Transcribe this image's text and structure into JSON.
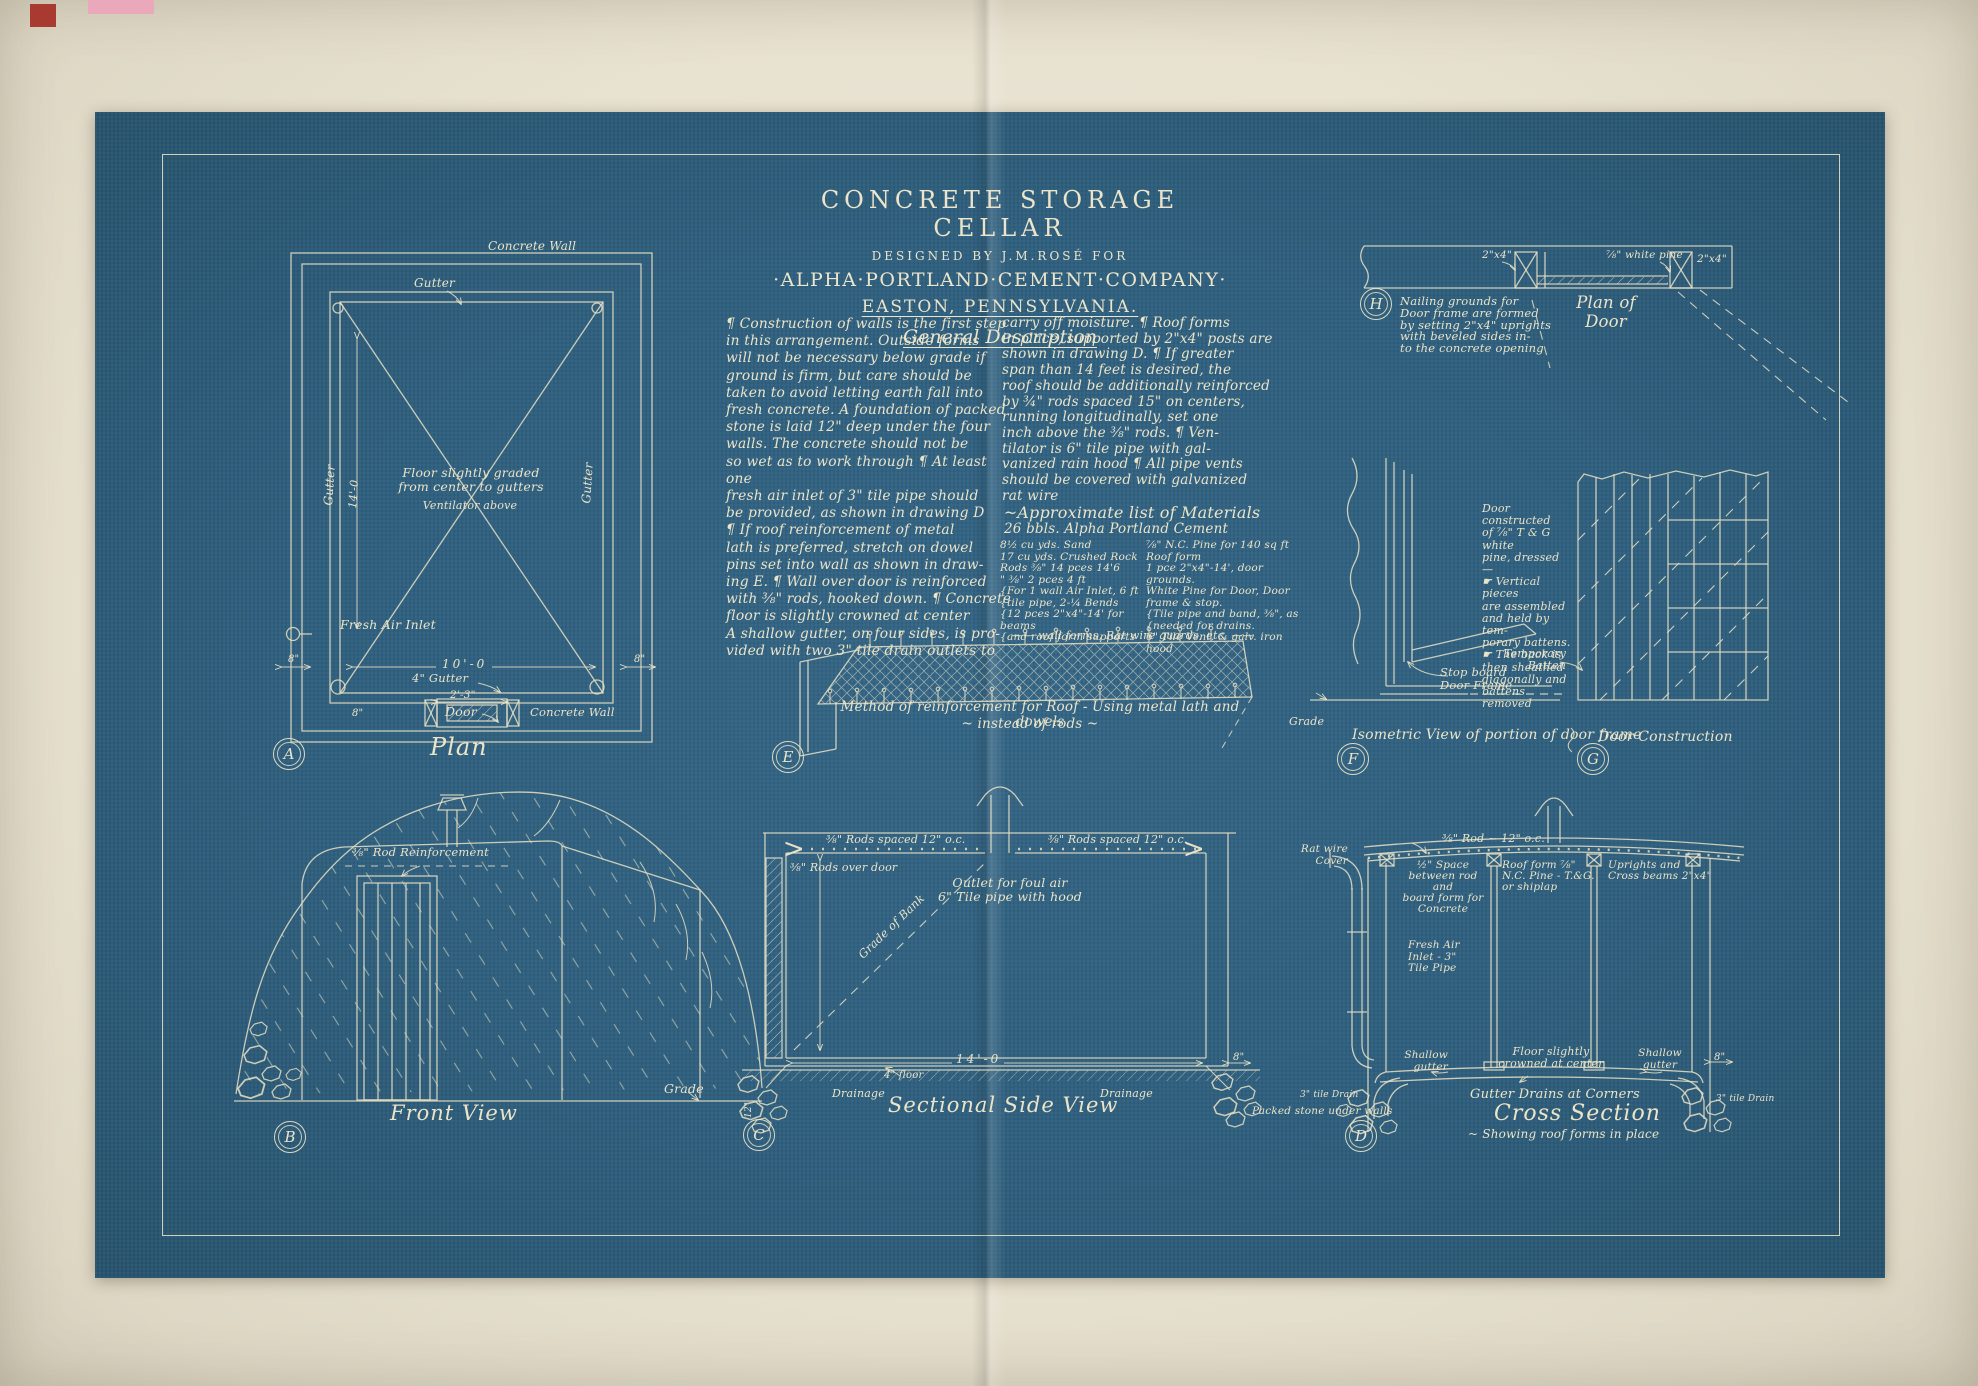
{
  "colors": {
    "blueprint": "#2e5f7e",
    "ink": "#ebe4c9",
    "paper": "#e8e2d1",
    "pink": "#e9a9bb",
    "red": "#a83a31"
  },
  "header": {
    "title": "CONCRETE STORAGE CELLAR",
    "designed_by": "DESIGNED BY J.M.ROSÉ FOR",
    "company": "·ALPHA·PORTLAND·CEMENT·COMPANY·",
    "location": "EASTON, PENNSYLVANIA.",
    "section": "General Description"
  },
  "description": {
    "col1": "¶  Construction of walls is the first step\nin this arrangement.  Outside forms\nwill not be necessary below grade if\nground is firm, but care should be\ntaken to avoid letting earth fall into\nfresh concrete. A foundation of packed\nstone is laid 12\" deep under the four\nwalls.  The concrete should not be\nso wet as to work through ¶ At least one\nfresh air inlet of 3\" tile pipe should\nbe provided, as shown in drawing D\n¶  If roof reinforcement of metal\nlath is preferred, stretch on dowel\npins set into wall as shown in draw-\ning E.  ¶ Wall over door is reinforced\nwith ⅜\" rods, hooked down. ¶ Concrete\nfloor is slightly crowned at center\nA shallow gutter, on four sides, is pro-\nvided with two 3\" tile drain outlets to",
    "col2": "carry off moisture.  ¶ Roof forms\nin place, supported by 2\"x4\" posts are\nshown in drawing D.  ¶ If greater\nspan than 14 feet is desired, the\nroof should be additionally reinforced\nby ¾\" rods spaced 15\" on centers,\nrunning longitudinally, set one\ninch above the ⅜\" rods.  ¶ Ven-\ntilator is 6\" tile pipe with gal-\nvanized rain hood ¶ All pipe vents\nshould be covered with galvanized\nrat wire"
  },
  "materials": {
    "heading": "~Approximate list of Materials",
    "cement": "26 bbls. Alpha Portland Cement",
    "left": "8½ cu yds. Sand\n17 cu yds. Crushed Rock\nRods ⅜\" 14 pces 14'6\n  \"   ⅜\"  2 pces  4 ft\n{For 1 wall Air Inlet, 6 ft\n{tile pipe, 2-¼ Bends\n{12 pces 2\"x4\"-14' for beams\n{and roof form supports",
    "right": "⅞\" N.C. Pine for 140 sq ft\nRoof form\n1 pce 2\"x4\"-14', door grounds.\nWhite Pine for Door, Door\nframe & stop.\n{Tile pipe and band, ⅜\", as\n{needed for drains.\n6\" Tile Vent. & galv. iron hood",
    "footer": "—— wall forms, Rat wire guards, etc. ——"
  },
  "plan": {
    "letter": "A",
    "caption": "Plan",
    "wall_top": "Concrete Wall",
    "gutter_top": "Gutter",
    "gutter_left": "Gutter",
    "gutter_right": "Gutter",
    "dim_height": "14'-0",
    "center_note": "Floor slightly graded\nfrom center to gutters",
    "center_sub": "Ventilator above",
    "fresh_air": "Fresh Air Inlet",
    "dim_width": "10'-0",
    "gutter_dim": "4\" Gutter",
    "wall_dim_left": "8\"",
    "wall_dim_right": "8\"",
    "door_dim": "2'-3\"",
    "door": "Door",
    "wall_bottom": "Concrete Wall",
    "door_wall_dim": "8\""
  },
  "lath": {
    "letter": "E",
    "caption1": "Method of reinforcement for Roof - Using metal lath and dowels",
    "caption2": "~ instead of rods ~"
  },
  "door_plan": {
    "letter": "H",
    "note": "Nailing grounds for\nDoor frame are formed\nby setting 2\"x4\" uprights\nwith beveled sides in-\nto the concrete opening",
    "label_left": "2\"x4\"",
    "label_pine": "⅞\" white pine",
    "label_right": "2\"x4\"",
    "caption": "Plan of\nDoor"
  },
  "frame_iso": {
    "letter": "F",
    "stop_board": "Stop board\nDoor Frame",
    "grade": "Grade",
    "caption": "Isometric View of portion of door frame"
  },
  "door_cons": {
    "letter": "G",
    "note": "Door constructed\nof ⅞\" T & G white\npine, dressed —\n☛ Vertical pieces\nare assembled\nand held by tem-\nporary battens.\n☛ The back is\nthen sheathed\ndiagonally and\nbattens removed",
    "batten": "Temporary\nBatten",
    "caption": "Door Construction"
  },
  "front": {
    "letter": "B",
    "rod": "⅜\" Rod Reinforcement",
    "grade": "Grade",
    "caption": "Front View"
  },
  "side_section": {
    "letter": "C",
    "rods_left": "⅜\" Rods spaced 12\" o.c.",
    "rods_right": "⅜\" Rods spaced 12\" o.c.",
    "rods_door": "⅜\" Rods over door",
    "outlet": "Outlet for foul air\n6\" Tile pipe with hood",
    "grade_bank": "Grade of Bank",
    "dim_width": "14'-0",
    "floor": "4\" floor",
    "drain_left": "Drainage",
    "drain_right": "Drainage",
    "wall_dim": "8\"",
    "found_dim": "12\"",
    "caption": "Sectional Side View"
  },
  "cross_section": {
    "letter": "D",
    "rod": "⅜\" Rod ~ 12\" o.c.",
    "ratwire": "Rat wire\nCover",
    "space_note": "½\" Space\nbetween rod and\nboard form for\nConcrete",
    "roof_note": "Roof form ⅞\"\nN.C. Pine - T.&G.\nor shiplap",
    "uprights": "Uprights and\nCross beams 2\"x4\"",
    "fresh_air": "Fresh Air\nInlet - 3\"\nTile Pipe",
    "floor_note": "Floor slightly\ncrowned at center",
    "shallow_left": "Shallow\ngutter",
    "shallow_right": "Shallow\ngutter",
    "wall_dim": "8\"",
    "stone": "Packed stone under walls",
    "drain_left": "3\" tile Drain",
    "drain_right": "3\" tile Drain",
    "cap1": "Gutter Drains at Corners",
    "cap2": "Cross Section",
    "cap3": "~ Showing roof forms in place"
  }
}
